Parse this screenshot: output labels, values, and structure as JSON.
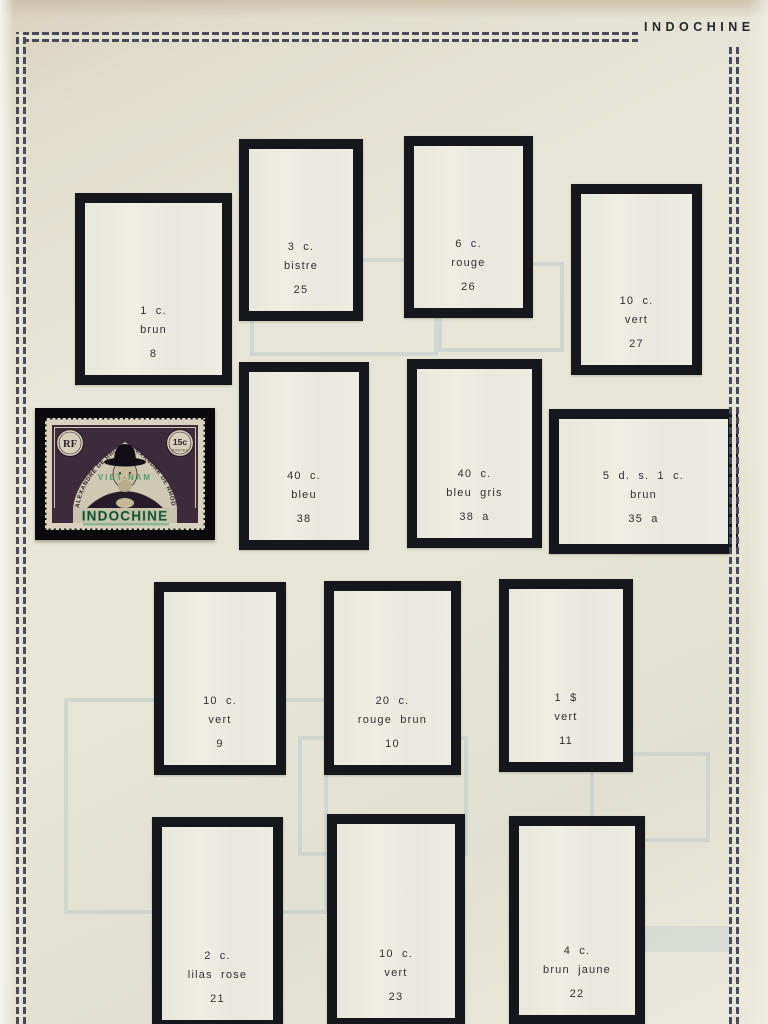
{
  "page": {
    "title": "INDOCHINE"
  },
  "stamp": {
    "country": "INDOCHINE",
    "value": "15c",
    "postes": "POSTES",
    "monogram": "RF",
    "arc_left": "ALEXANDRE DE RHODES",
    "arc_right": "ALEXANDRE DE RHODES",
    "overprint": "VIET-NAM"
  },
  "slots": [
    {
      "denomination": "1 c.",
      "color": "brun",
      "number": "8"
    },
    {
      "denomination": "3 c.",
      "color": "bistre",
      "number": "25"
    },
    {
      "denomination": "6 c.",
      "color": "rouge",
      "number": "26"
    },
    {
      "denomination": "10 c.",
      "color": "vert",
      "number": "27"
    },
    {
      "denomination": "40 c.",
      "color": "bleu",
      "number": "38"
    },
    {
      "denomination": "40 c.",
      "color": "bleu gris",
      "number": "38 a"
    },
    {
      "denomination": "5 d. s. 1 c.",
      "color": "brun",
      "number": "35 a"
    },
    {
      "denomination": "10 c.",
      "color": "vert",
      "number": "9"
    },
    {
      "denomination": "20 c.",
      "color": "rouge brun",
      "number": "10"
    },
    {
      "denomination": "1 $",
      "color": "vert",
      "number": "11"
    },
    {
      "denomination": "2 c.",
      "color": "lilas rose",
      "number": "21"
    },
    {
      "denomination": "10 c.",
      "color": "vert",
      "number": "23"
    },
    {
      "denomination": "4 c.",
      "color": "brun jaune",
      "number": "22"
    }
  ],
  "colors": {
    "frame": "#16161d",
    "paper": "#e6e4d5",
    "chain": "#4a4a5c",
    "slot_fill": "#ebe9de",
    "stamp_violet": "#3c2b3a",
    "overprint_green": "#2f9157"
  }
}
